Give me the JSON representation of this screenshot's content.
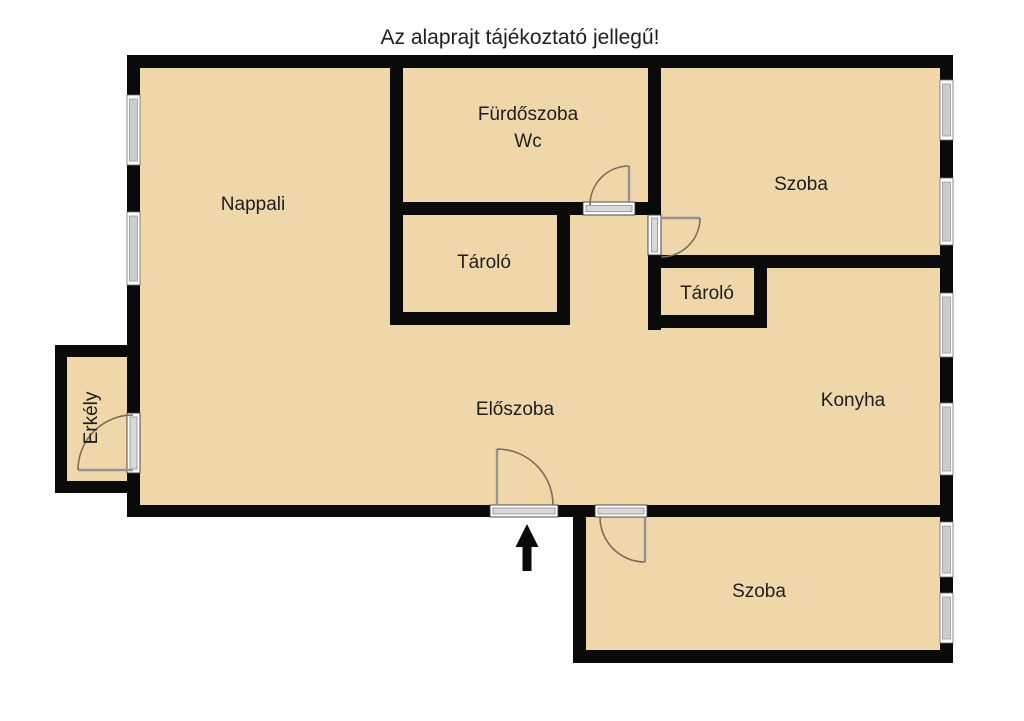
{
  "title": "Az alaprajt tájékoztató jellegű!",
  "rooms": {
    "nappali": {
      "label": "Nappali"
    },
    "furdoszoba": {
      "label_line1": "Fürdőszoba",
      "label_line2": "Wc"
    },
    "tarolo_felso": {
      "label": "Tároló"
    },
    "szoba_felso": {
      "label": "Szoba"
    },
    "tarolo_jobb": {
      "label": "Tároló"
    },
    "eloszoba": {
      "label": "Előszoba"
    },
    "konyha": {
      "label": "Konyha"
    },
    "erkely": {
      "label": "Erkély"
    },
    "szoba_also": {
      "label": "Szoba"
    }
  },
  "colors": {
    "background": "#ffffff",
    "wall": "#0a0a0a",
    "floor": "#f0d7aa",
    "window_frame": "#ffffff",
    "window_glass": "#cdcdcd",
    "door_arc": "#7b6c58",
    "text": "#1e1e1e"
  },
  "icons": {
    "entrance_arrow": "arrow-up"
  }
}
